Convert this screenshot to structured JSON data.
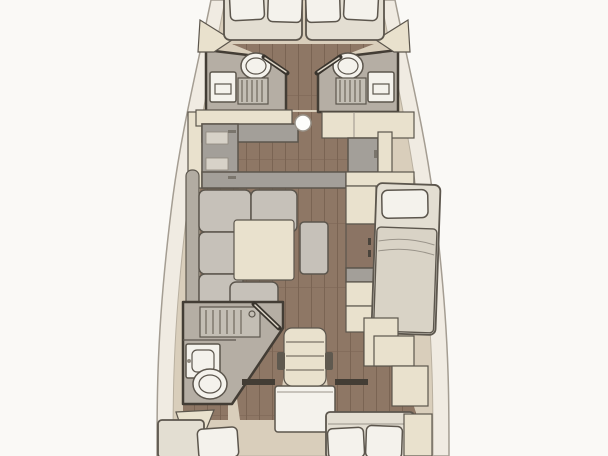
{
  "scene": {
    "description": "Top-down interior floor plan of a sailing yacht, bow at top and stern at bottom",
    "areas": [
      {
        "name": "bow-cabin",
        "fixtures": [
          "v-berth-mattress",
          "pillow",
          "pillow",
          "pillow",
          "pillow",
          "side-lockers"
        ]
      },
      {
        "name": "port-forward-head",
        "fixtures": [
          "toilet",
          "shower-grate",
          "sink-unit",
          "door"
        ]
      },
      {
        "name": "starboard-forward-head",
        "fixtures": [
          "toilet",
          "shower-grate",
          "sink-unit",
          "door"
        ]
      },
      {
        "name": "galley",
        "fixtures": [
          "u-shaped-counter",
          "side-lockers",
          "mast-post",
          "counter-top"
        ]
      },
      {
        "name": "starboard-counter",
        "fixtures": [
          "counter-top",
          "fridge-cabinet",
          "shelf"
        ]
      },
      {
        "name": "salon",
        "fixtures": [
          "l-shaped-sofa",
          "square-table",
          "bench-ottoman"
        ]
      },
      {
        "name": "starboard-side",
        "fixtures": [
          "cabinet-column",
          "pilot-berth",
          "pillow",
          "blanket"
        ]
      },
      {
        "name": "aft-head",
        "fixtures": [
          "shower-grate",
          "sink-unit",
          "toilet",
          "door"
        ]
      },
      {
        "name": "companionway",
        "fixtures": [
          "step-seat",
          "engine-platform",
          "door-lintels"
        ]
      },
      {
        "name": "port-aft-cabin",
        "fixtures": [
          "berth-mattress",
          "pillow",
          "seat-wedge"
        ]
      },
      {
        "name": "starboard-aft-cabin",
        "fixtures": [
          "berth-mattress",
          "pillow",
          "pillow",
          "foot-locker"
        ]
      }
    ]
  },
  "palette": {
    "background": "#faf9f6",
    "hull_band": "#f0ebe2",
    "hull_line": "#a49d92",
    "deck_base": "#d9cebb",
    "deck_line": "#b9b0a0",
    "wood_floor": "#8e7765",
    "wood_line": "#7a6453",
    "wall": "#433d35",
    "bath_gray": "#b5aea4",
    "counter_gray": "#a39f99",
    "sofa_gray": "#c6c1b9",
    "sofa_dark": "#b2aca2",
    "cream": "#e9e1cd",
    "white_fixture": "#f4f2ec",
    "bed_linen": "#e3ded2",
    "blanket": "#d9d3c6",
    "wood_cabinet": "#8b7464",
    "outline": "#5c564d",
    "door_dark": "#39342d",
    "door_light": "#ddd6c8"
  }
}
